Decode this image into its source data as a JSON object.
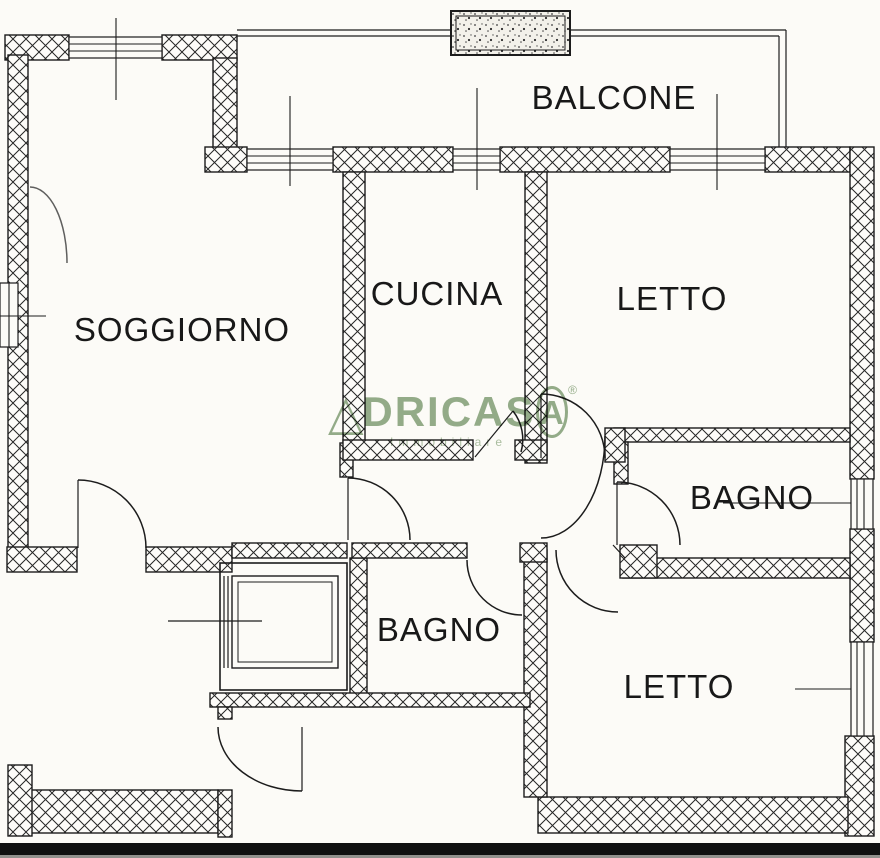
{
  "rooms": {
    "soggiorno": "SOGGIORNO",
    "cucina": "CUCINA",
    "letto_top": "LETTO",
    "balcone": "BALCONE",
    "bagno_top": "BAGNO",
    "bagno_bottom": "BAGNO",
    "letto_bottom": "LETTO"
  },
  "watermark": {
    "brand_full": "ADRICASA",
    "logo_glyph": "△",
    "brand_mid": "DRICAS",
    "brand_last": "A",
    "registered": "®",
    "subtitle": "Immobiliare",
    "color_primary": "#7e9c72",
    "color_subtitle": "#9ab290"
  },
  "colors": {
    "ink": "#1c1c1c",
    "paper": "#fcfbf7",
    "scan_bar": "#101010"
  }
}
